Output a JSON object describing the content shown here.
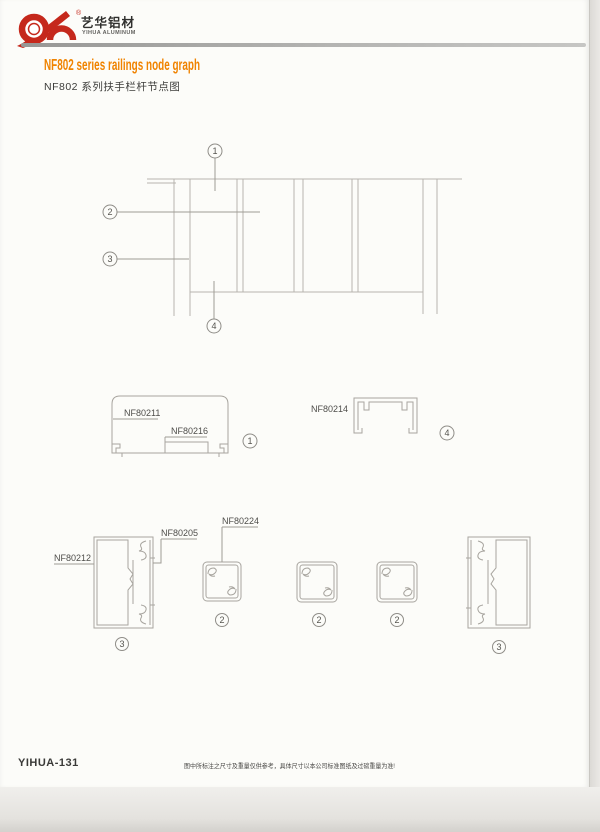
{
  "page": {
    "header": {
      "brand_cn": "艺华铝材",
      "brand_en": "YIHUA ALUMINUM",
      "reg_mark": "®"
    },
    "title": {
      "en": "NF802 series railings node graph",
      "cn": "NF802 系列扶手栏杆节点图"
    },
    "colors": {
      "accent_orange": "#f08300",
      "logo_red": "#c5281c",
      "drawing_line_gray": "#b7b4ae",
      "divider_gray": "#a5a5a3"
    },
    "callouts": {
      "c1": "1",
      "c2": "2",
      "c3": "3",
      "c4": "4"
    },
    "labels": {
      "nf80211": "NF80211",
      "nf80216": "NF80216",
      "nf80214": "NF80214",
      "nf80212": "NF80212",
      "nf80205": "NF80205",
      "nf80224": "NF80224"
    },
    "footer": {
      "page_code": "YIHUA-131",
      "note": "图中所标注之尺寸及重量仅供参考，具体尺寸以本公司标准图纸及过磅重量为准!"
    }
  }
}
